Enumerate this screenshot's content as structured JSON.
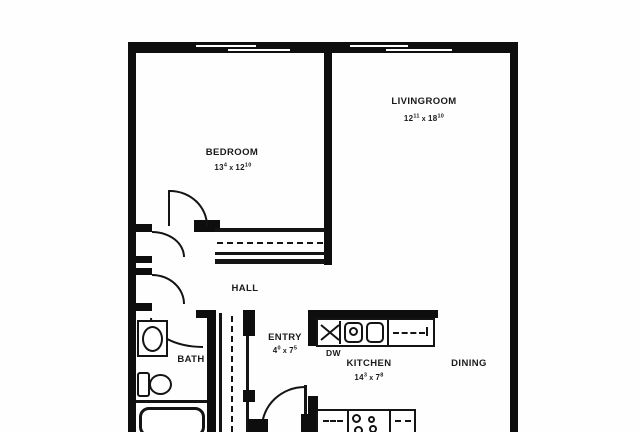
{
  "plan": {
    "title": "apartment-floor-plan",
    "rooms": {
      "bedroom": {
        "label": "BEDROOM",
        "dim_a": "13",
        "dim_a_sup": "4",
        "dim_sep": "x",
        "dim_b": "12",
        "dim_b_sup": "10"
      },
      "livingroom": {
        "label": "LIVINGROOM",
        "dim_a": "12",
        "dim_a_sup": "11",
        "dim_sep": "x",
        "dim_b": "18",
        "dim_b_sup": "10"
      },
      "kitchen": {
        "label": "KITCHEN",
        "dim_a": "14",
        "dim_a_sup": "3",
        "dim_sep": "x",
        "dim_b": "7",
        "dim_b_sup": "8"
      },
      "entry": {
        "label": "ENTRY",
        "dim_a": "4",
        "dim_a_sup": "0",
        "dim_sep": "x",
        "dim_b": "7",
        "dim_b_sup": "5"
      },
      "hall": {
        "label": "HALL"
      },
      "bath": {
        "label": "BATH"
      },
      "dining": {
        "label": "DINING"
      }
    },
    "fixtures": {
      "dishwasher_label": "DW"
    },
    "colors": {
      "wall": "#0e0e0e",
      "ink": "#1a1a1a",
      "paper": "#fefefe"
    }
  }
}
